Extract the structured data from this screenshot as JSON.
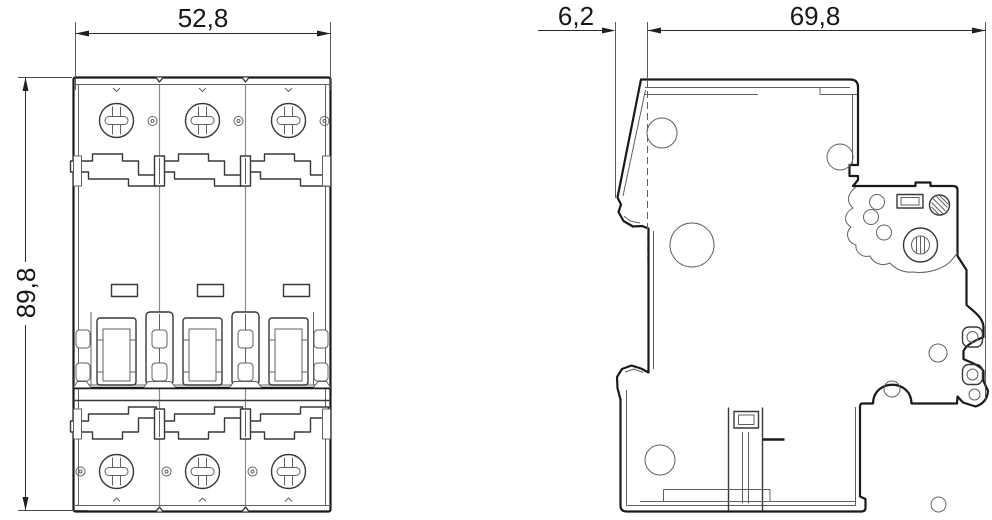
{
  "drawing": {
    "type": "technical-dimension-drawing",
    "subject": "3-pole miniature circuit breaker",
    "front_view": {
      "width_dim": "52,8",
      "height_dim": "89,8"
    },
    "side_view": {
      "front_offset_dim": "6,2",
      "depth_dim": "69,8"
    },
    "colors": {
      "line_dark": "#1a1a1a",
      "line_medium": "#383838",
      "line_thin": "#606060",
      "divider_gray": "#8a8a8a",
      "background": "#ffffff"
    }
  }
}
